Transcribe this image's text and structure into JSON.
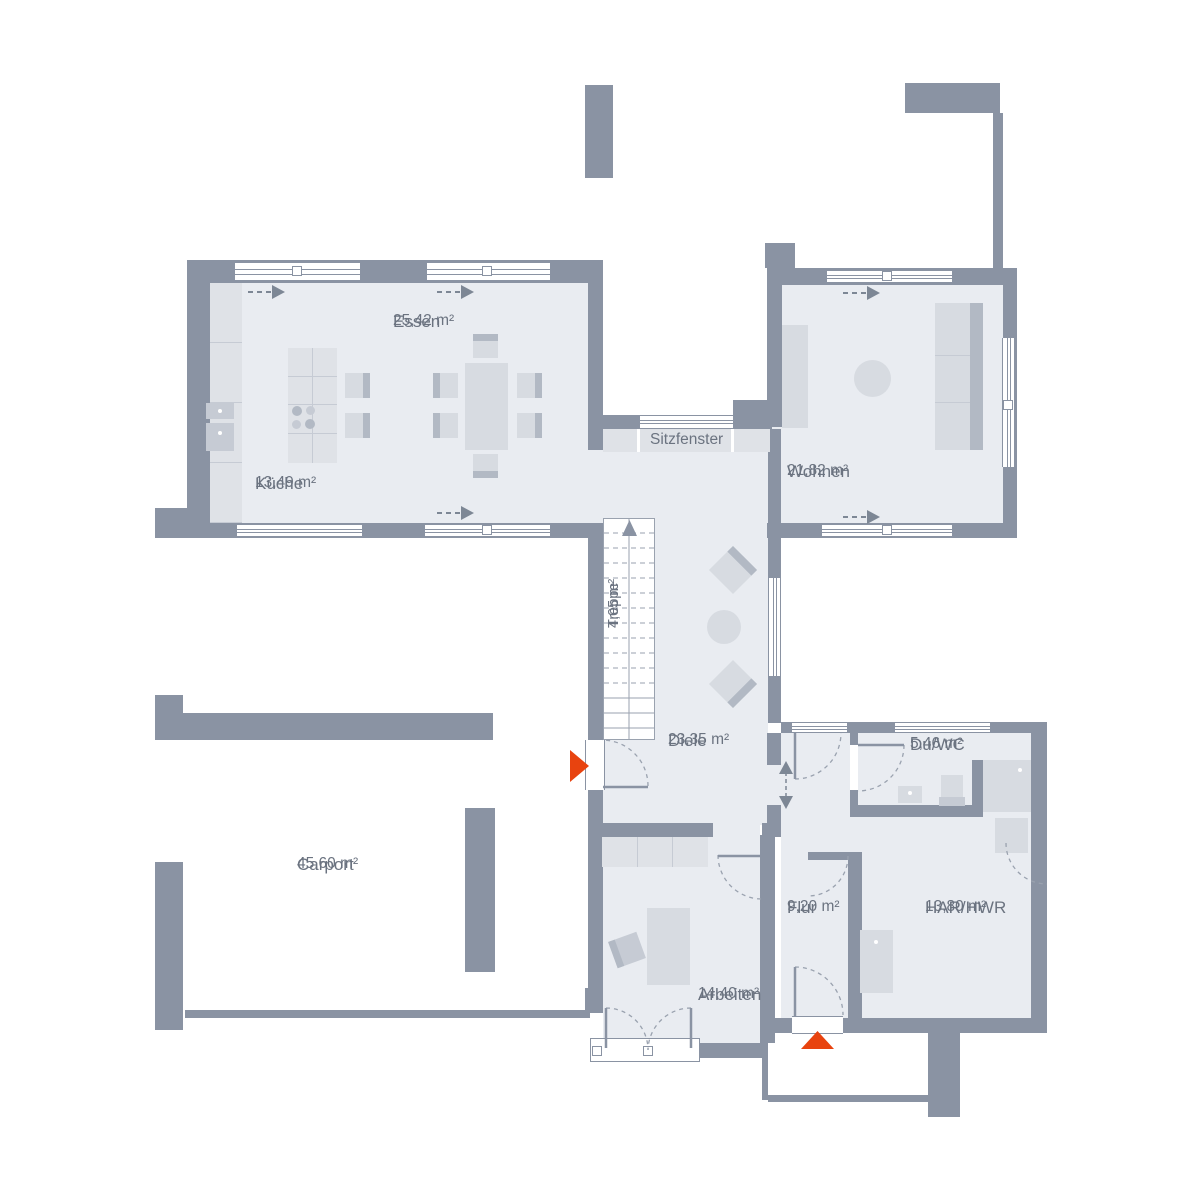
{
  "plan_title": "Erdgeschoss Grundriss",
  "rooms": {
    "essen": {
      "name": "Essen",
      "area": "25,42 m²"
    },
    "kueche": {
      "name": "Küche",
      "area": "13,49 m²"
    },
    "wohnen": {
      "name": "Wohnen",
      "area": "21,82 m²"
    },
    "treppe": {
      "name": "Treppe",
      "area": "4,05 m²"
    },
    "diele": {
      "name": "Diele",
      "area": "23,35 m²"
    },
    "duwc": {
      "name": "Du/WC",
      "area": "5,46 m²"
    },
    "flur": {
      "name": "Flur",
      "area": "9,20 m²"
    },
    "harhwr": {
      "name": "HAR/HWR",
      "area": "13,80 m²"
    },
    "arbeiten": {
      "name": "Arbeiten",
      "area": "14,40 m²"
    },
    "carport": {
      "name": "Carport",
      "area": "45,60 m²"
    }
  },
  "annotations": {
    "sitzfenster": "Sitzfenster"
  },
  "colors": {
    "wall": "#8a93a3",
    "floor": "#e9ecf1",
    "furniture": "#d7dbe1",
    "entry_arrow": "#e8430f",
    "text": "#6b7380"
  }
}
